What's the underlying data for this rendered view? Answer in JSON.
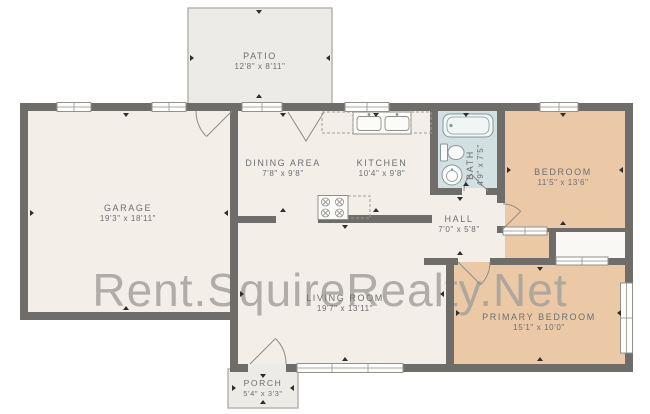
{
  "watermark": "Rent.SquireRealty.Net",
  "rooms": {
    "patio": {
      "name": "PATIO",
      "dims": "12'8\" x 8'11\""
    },
    "garage": {
      "name": "GARAGE",
      "dims": "19'3\" x 18'11\""
    },
    "dining": {
      "name": "DINING AREA",
      "dims": "7'8\" x 9'8\""
    },
    "kitchen": {
      "name": "KITCHEN",
      "dims": "10'4\" x 9'8\""
    },
    "bath": {
      "name": "BATH",
      "dims": "4'9\" x 7'5\""
    },
    "bedroom": {
      "name": "BEDROOM",
      "dims": "11'5\" x 13'6\""
    },
    "hall": {
      "name": "HALL",
      "dims": "7'0\" x 5'8\""
    },
    "living": {
      "name": "LIVING ROOM",
      "dims": "19'7\" x 13'11\""
    },
    "primary": {
      "name": "PRIMARY BEDROOM",
      "dims": "15'1\" x 10'0\""
    },
    "porch": {
      "name": "PORCH",
      "dims": "5'4\" x 3'3\""
    }
  },
  "colors": {
    "wall": "#6f6d69",
    "floor": "#f3eee7",
    "bedroom-fill": "#ecc9a6",
    "bath-fill": "#d2e0e2",
    "outdoor-fill": "#edebe8",
    "outdoor-border": "#b7b4ae",
    "label-text": "#6b6e72",
    "watermark-text": "#a09e9a"
  }
}
